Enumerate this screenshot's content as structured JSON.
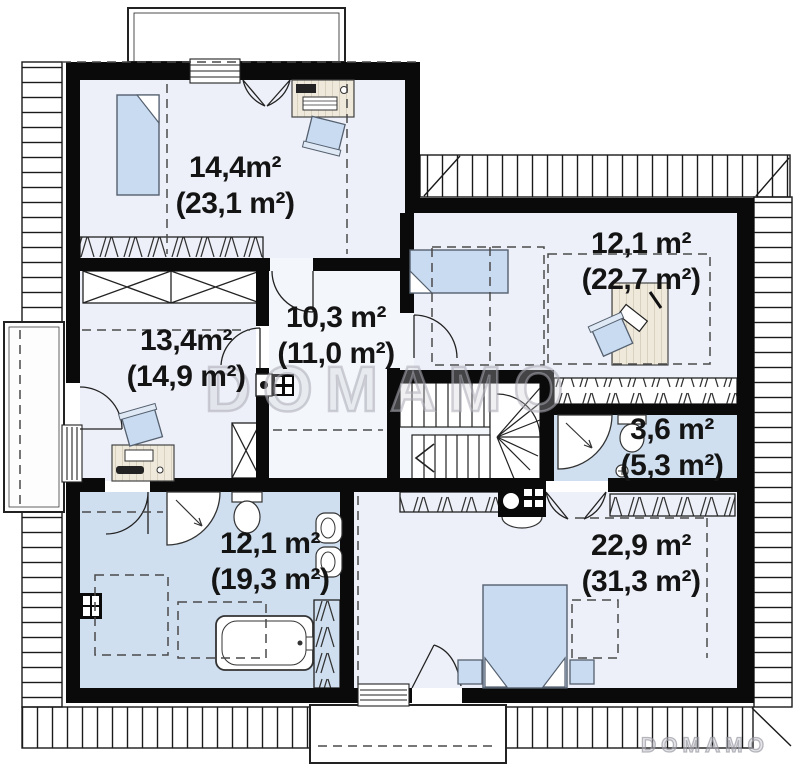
{
  "watermark": "DOMAMO",
  "brand_logo": "DOMAMO",
  "colors": {
    "wall": "#0a0a0a",
    "room_fill": "#edf0f8",
    "wet_room_fill": "#cfdff0",
    "furniture_blue": "#c8dbf1",
    "hatch_line": "#1a1a1a",
    "dashed_line": "#4a4a4a"
  },
  "rooms": [
    {
      "name": "bedroom-top-left",
      "area": "14,4m²",
      "area_total": "(23,1 m²)"
    },
    {
      "name": "bedroom-top-right",
      "area": "12,1 m²",
      "area_total": "(22,7 m²)"
    },
    {
      "name": "hall",
      "area": "10,3 m²",
      "area_total": "(11,0 m²)"
    },
    {
      "name": "room-left",
      "area": "13,4m²",
      "area_total": "(14,9 m²)"
    },
    {
      "name": "bathroom-small",
      "area": "3,6 m²",
      "area_total": "(5,3 m²)"
    },
    {
      "name": "bathroom-main",
      "area": "12,1 m²",
      "area_total": "(19,3 m²)"
    },
    {
      "name": "bedroom-bottom-right",
      "area": "22,9 m²",
      "area_total": "(31,3 m²)"
    }
  ]
}
